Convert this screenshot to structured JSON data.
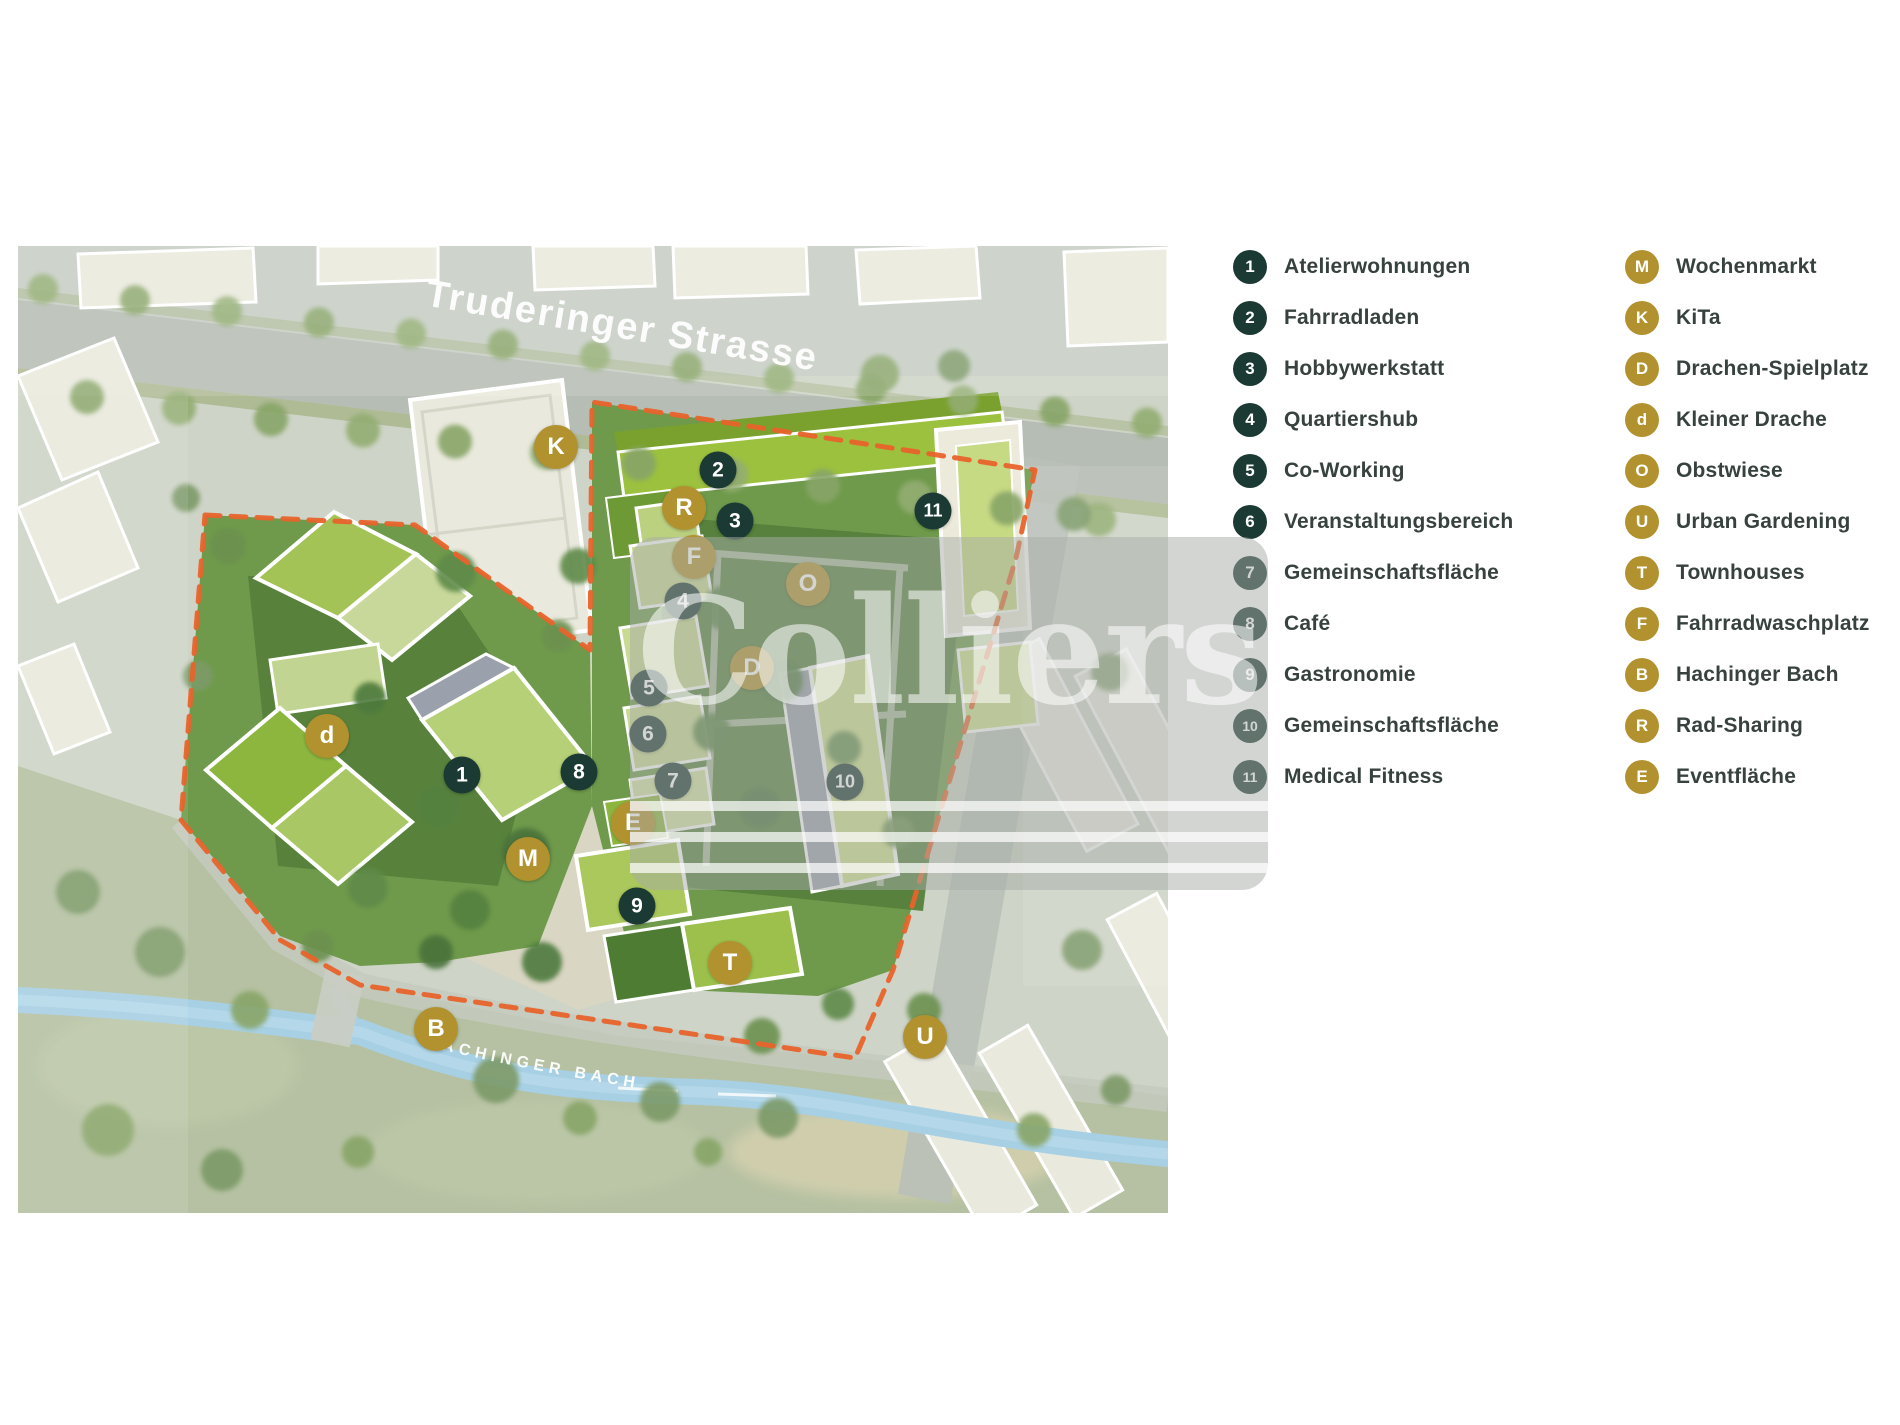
{
  "watermark": {
    "text": "Colliers"
  },
  "map": {
    "street_label": "Truderinger Strasse",
    "stream_label": "HACHINGER BACH",
    "markers": [
      {
        "key": "K",
        "type": "gold",
        "x": 556,
        "y": 447
      },
      {
        "key": "2",
        "type": "dark",
        "x": 718,
        "y": 470
      },
      {
        "key": "R",
        "type": "gold",
        "x": 684,
        "y": 508
      },
      {
        "key": "3",
        "type": "dark",
        "x": 735,
        "y": 521
      },
      {
        "key": "F",
        "type": "gold",
        "x": 694,
        "y": 557
      },
      {
        "key": "4",
        "type": "dark",
        "x": 683,
        "y": 601
      },
      {
        "key": "O",
        "type": "gold",
        "x": 808,
        "y": 584
      },
      {
        "key": "11",
        "type": "dark",
        "x": 933,
        "y": 511
      },
      {
        "key": "5",
        "type": "dark",
        "x": 649,
        "y": 688
      },
      {
        "key": "D",
        "type": "gold",
        "x": 752,
        "y": 668
      },
      {
        "key": "6",
        "type": "dark",
        "x": 648,
        "y": 734
      },
      {
        "key": "8",
        "type": "dark",
        "x": 579,
        "y": 772
      },
      {
        "key": "7",
        "type": "dark",
        "x": 673,
        "y": 781
      },
      {
        "key": "10",
        "type": "dark",
        "x": 845,
        "y": 782
      },
      {
        "key": "d",
        "type": "gold",
        "x": 327,
        "y": 736
      },
      {
        "key": "1",
        "type": "dark",
        "x": 462,
        "y": 775
      },
      {
        "key": "E",
        "type": "gold",
        "x": 633,
        "y": 823
      },
      {
        "key": "M",
        "type": "gold",
        "x": 528,
        "y": 859
      },
      {
        "key": "9",
        "type": "dark",
        "x": 637,
        "y": 906
      },
      {
        "key": "T",
        "type": "gold",
        "x": 730,
        "y": 963
      },
      {
        "key": "B",
        "type": "gold",
        "x": 436,
        "y": 1029
      },
      {
        "key": "U",
        "type": "gold",
        "x": 925,
        "y": 1037
      }
    ]
  },
  "legend": {
    "column1": [
      {
        "key": "1",
        "label": "Atelierwohnungen"
      },
      {
        "key": "2",
        "label": "Fahrradladen"
      },
      {
        "key": "3",
        "label": "Hobbywerkstatt"
      },
      {
        "key": "4",
        "label": "Quartiershub"
      },
      {
        "key": "5",
        "label": "Co-Working"
      },
      {
        "key": "6",
        "label": "Veranstaltungsbereich"
      },
      {
        "key": "7",
        "label": "Gemeinschaftsfläche"
      },
      {
        "key": "8",
        "label": "Café"
      },
      {
        "key": "9",
        "label": "Gastronomie"
      },
      {
        "key": "10",
        "label": "Gemeinschaftsfläche"
      },
      {
        "key": "11",
        "label": "Medical Fitness"
      }
    ],
    "column2": [
      {
        "key": "M",
        "label": "Wochenmarkt"
      },
      {
        "key": "K",
        "label": "KiTa"
      },
      {
        "key": "D",
        "label": "Drachen-Spielplatz"
      },
      {
        "key": "d",
        "label": "Kleiner Drache"
      },
      {
        "key": "O",
        "label": "Obstwiese"
      },
      {
        "key": "U",
        "label": "Urban Gardening"
      },
      {
        "key": "T",
        "label": "Townhouses"
      },
      {
        "key": "F",
        "label": "Fahrradwaschplatz"
      },
      {
        "key": "B",
        "label": "Hachinger Bach"
      },
      {
        "key": "R",
        "label": "Rad-Sharing"
      },
      {
        "key": "E",
        "label": "Eventfläche"
      }
    ]
  },
  "colors": {
    "marker_dark": "#1c3a34",
    "marker_gold": "#b2922f",
    "boundary_orange": "#e8632b",
    "stream_blue": "#a7d0e4",
    "legend_text": "#37423f"
  }
}
